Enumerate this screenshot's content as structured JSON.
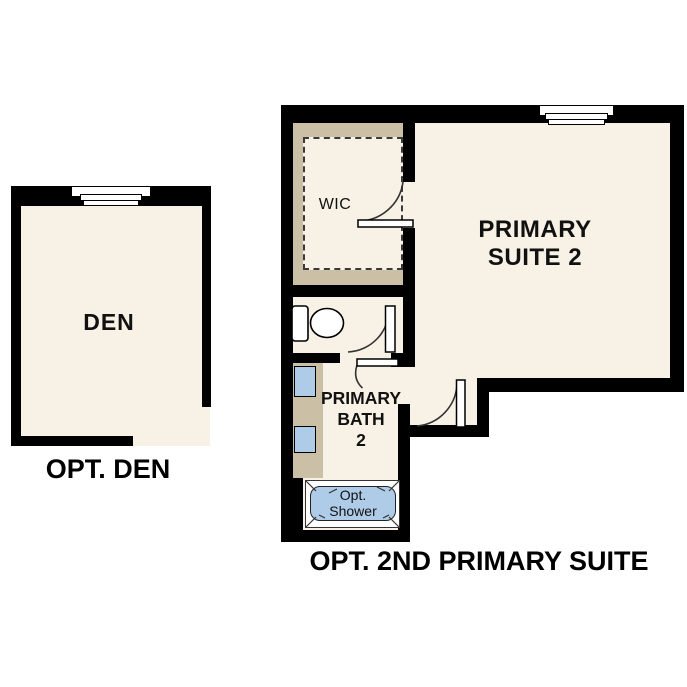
{
  "colors": {
    "bg": "#ffffff",
    "wall": "#000000",
    "floor": "#f8f1e5",
    "tan": "#cbbfa6",
    "fixture_blue": "#aecbe8",
    "text": "#111111"
  },
  "den_plan": {
    "room_label": "DEN",
    "caption": "OPT. DEN"
  },
  "suite_plan": {
    "caption": "OPT. 2ND PRIMARY SUITE",
    "wic_label": "WIC",
    "suite_label": {
      "line1": "PRIMARY",
      "line2": "SUITE 2"
    },
    "bath_label": {
      "line1": "PRIMARY",
      "line2": "BATH",
      "line3": "2"
    },
    "shower_label": {
      "line1": "Opt.",
      "line2": "Shower"
    }
  },
  "icons": {
    "window": "window-symbol",
    "toilet": "toilet-symbol",
    "sink": "sink-symbol",
    "door": "door-swing-symbol",
    "shower": "optional-shower-symbol"
  }
}
